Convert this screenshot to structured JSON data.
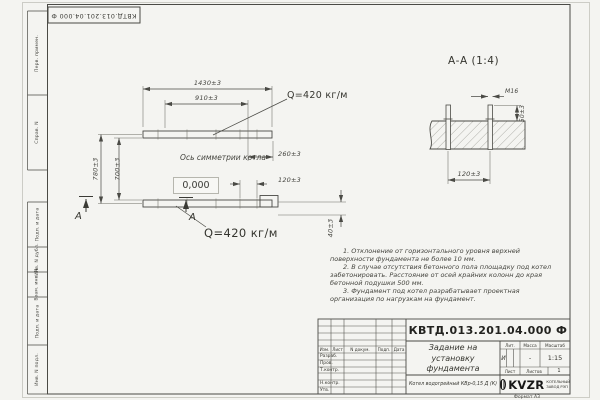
{
  "frame": {
    "stamp_top": "КВТД.013.201.04.000 Ф",
    "side_top": {
      "perv": "Перв. примен.",
      "sprav": "Справ. N"
    },
    "side_bottom": {
      "podp1": "Подп. и дата",
      "inv_dubl": "Инв. N дубл.",
      "vzam": "Взам. инв. N",
      "podp2": "Подп. и дата",
      "inv_podl": "Инв. N подл."
    },
    "format_note": "Формат А3"
  },
  "plan": {
    "dim_overall": "1430±3",
    "dim_inner": "910±3",
    "dim_left_outer": "780±3",
    "dim_left_inner": "700±3",
    "dim_right_offset": "260±3",
    "dim_bolt_spacing": "120±3",
    "dim_rail_width": "40±3",
    "elevation": "0,000",
    "axis_label": "Ось симметрии котла",
    "load_top": "Q=420 кг/м",
    "load_bottom": "Q=420 кг/м",
    "section_letter_left": "А",
    "section_letter_right": "А"
  },
  "section": {
    "title": "А-А (1:4)",
    "bolt_label": "М16",
    "dim_height": "50±3",
    "dim_spacing": "120±3"
  },
  "notes": {
    "items": [
      "1. Отклонение от горизонтального уровня верхней поверхности фундамента не более 10 мм.",
      "2. В случае отсутствия бетонного пола площадку под котел забетонировать. Расстояние от осей крайних колонн до края бетонной подушки 500 мм.",
      "3. Фундамент под котел разрабатывает проектная организация по нагрузкам на фундамент."
    ]
  },
  "title_block": {
    "doc_number": "КВТД.013.201.04.000 Ф",
    "title_line1": "Задание на",
    "title_line2": "установку",
    "title_line3": "фундамента",
    "product": "Котел водогрейный КВр-0,15 Д (К)",
    "header_cols": [
      "Изм.",
      "Лист",
      "N докум.",
      "Подп.",
      "Дата"
    ],
    "roles": [
      "Разраб.",
      "Пров.",
      "Т.контр.",
      "Н.контр.",
      "Утв."
    ],
    "lit_header": "Лит.",
    "lit_value": "И",
    "mass_header": "Масса",
    "mass_value": "-",
    "scale_header": "Масштаб",
    "scale_value": "1:15",
    "sheet_header": "Лист",
    "sheets_header": "Листов",
    "sheets_value": "1",
    "logo_text": "KVZR",
    "logo_sub1": "КОТЕЛЬНЫЙ",
    "logo_sub2": "ЗАВОД РЭП"
  }
}
